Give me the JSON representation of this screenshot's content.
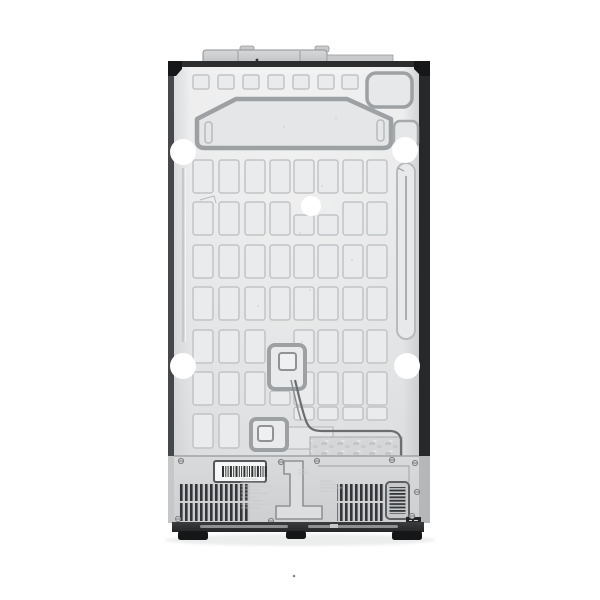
{
  "meta": {
    "subject": "refrigerator-back-panel-product-photo",
    "description_name": "rear-view-of-side-by-side-refrigerator",
    "background": "#ffffff"
  },
  "colors": {
    "bg": "#ffffff",
    "panel_hi": "#ededee",
    "panel_lo": "#dcdedf",
    "dent_fill": "#e9ebec",
    "dent_stroke": "#c1c4c6",
    "line_mid": "#9da1a4",
    "line_soft": "#b8bbbd",
    "etch": "#c6c9cb",
    "edge_left": "#45474a",
    "edge_right": "#26282a",
    "edge_top": "#2b2d2f",
    "bracket": "#151719",
    "section": "#d8dadb",
    "section_lo": "#cdcfd1",
    "vent_dark": "#34373a",
    "vent_bg": "#c9cbcd",
    "base_dark": "#2f3133",
    "foot": "#141618",
    "cable": "#6b6e71",
    "white": "#ffffff"
  },
  "figure": {
    "grid": {
      "col_x": [
        193,
        219,
        245,
        270,
        294,
        318,
        343,
        367
      ],
      "rect_w": 20,
      "row_y": [
        160,
        202,
        245,
        287,
        330,
        372
      ],
      "rect_h": 33,
      "overrides": {
        "1,4": {
          "y": 215,
          "h": 20
        },
        "1,5": {
          "y": 215,
          "h": 20
        },
        "4,3": null,
        "5,3": {
          "y": 391,
          "h": 14
        }
      },
      "extra": [
        {
          "x": 193,
          "y": 414,
          "w": 20,
          "h": 34
        },
        {
          "x": 219,
          "y": 414,
          "w": 20,
          "h": 34
        },
        {
          "x": 294,
          "y": 407,
          "w": 20,
          "h": 13
        },
        {
          "x": 318,
          "y": 407,
          "w": 20,
          "h": 13
        },
        {
          "x": 343,
          "y": 407,
          "w": 20,
          "h": 13
        },
        {
          "x": 367,
          "y": 407,
          "w": 20,
          "h": 13
        }
      ]
    },
    "top_squares": {
      "xs": [
        193,
        218,
        243,
        268,
        293,
        318,
        342
      ],
      "y": 75,
      "w": 16,
      "h": 14
    },
    "holes": [
      {
        "x": 183,
        "y": 152,
        "r": 13
      },
      {
        "x": 405,
        "y": 150,
        "r": 13
      },
      {
        "x": 311,
        "y": 206,
        "r": 10
      },
      {
        "x": 183,
        "y": 366,
        "r": 13
      },
      {
        "x": 407,
        "y": 366,
        "r": 13
      }
    ],
    "screws": [
      [
        181,
        461
      ],
      [
        281,
        462
      ],
      [
        317,
        461
      ],
      [
        392,
        460
      ],
      [
        415,
        463
      ],
      [
        417,
        492
      ],
      [
        412,
        516
      ],
      [
        271,
        521
      ],
      [
        178,
        519
      ]
    ],
    "feet": [
      {
        "x": 178,
        "y": 531,
        "w": 30,
        "h": 9
      },
      {
        "x": 286,
        "y": 531,
        "w": 20,
        "h": 8
      },
      {
        "x": 392,
        "y": 531,
        "w": 30,
        "h": 9
      }
    ],
    "barcode": {
      "x": 214,
      "y": 461,
      "w": 52,
      "h": 21,
      "bar_y": 466,
      "bar_h": 11,
      "bar_x0": 222,
      "bars": [
        2,
        1,
        1,
        2,
        1,
        2,
        1,
        1,
        2,
        1,
        1,
        2,
        1,
        2,
        1,
        1,
        2
      ]
    },
    "etched_blocks": [
      {
        "x": 241,
        "y": 479,
        "lines": 9,
        "maxw": 30,
        "gap": 3.6
      },
      {
        "x": 320,
        "y": 481,
        "lines": 4,
        "maxw": 22,
        "gap": 3.4
      },
      {
        "x": 298,
        "y": 470,
        "lines": 2,
        "maxw": 14,
        "gap": 3.2
      }
    ],
    "dust_dots": [
      [
        322,
        186
      ],
      [
        300,
        233
      ],
      [
        310,
        290
      ],
      [
        336,
        118
      ],
      [
        284,
        127
      ],
      [
        258,
        306
      ],
      [
        352,
        260
      ],
      [
        302,
        342
      ]
    ],
    "artifact_dot": {
      "x": 294,
      "y": 576,
      "r": 1.3
    }
  }
}
